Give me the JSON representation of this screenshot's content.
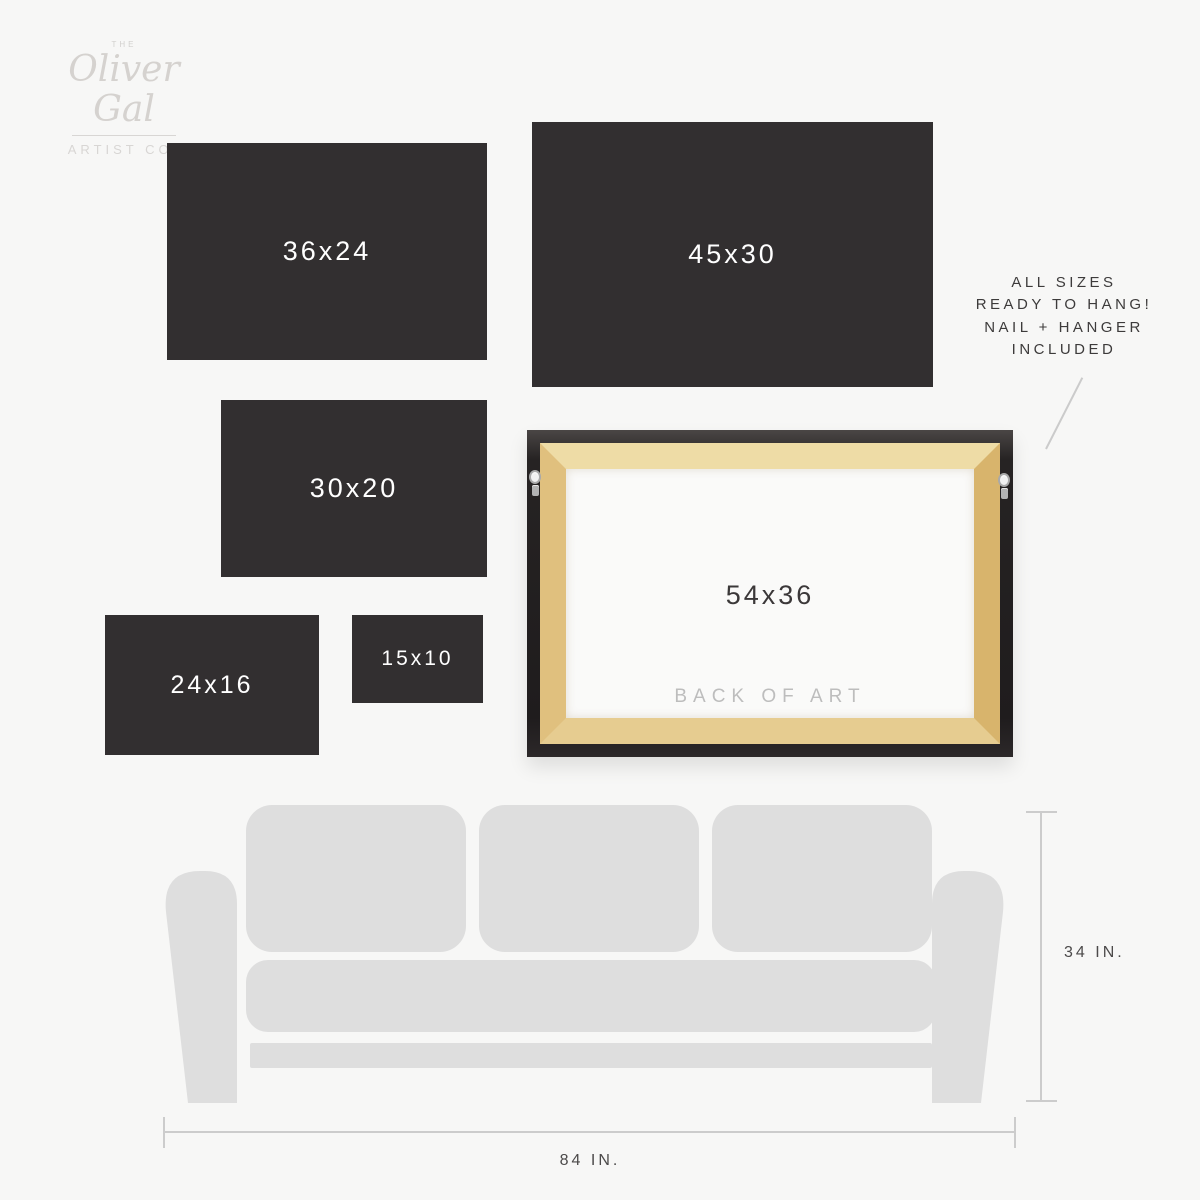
{
  "brand": {
    "pre": "THE",
    "name": "Oliver Gal",
    "sub": "ARTIST CO."
  },
  "panels": [
    {
      "label": "36x24"
    },
    {
      "label": "45x30"
    },
    {
      "label": "30x20"
    },
    {
      "label": "24x16"
    },
    {
      "label": "15x10"
    }
  ],
  "frame": {
    "size_label": "54x36",
    "caption": "BACK OF ART"
  },
  "note": {
    "line1": "ALL SIZES",
    "line2": "READY TO HANG!",
    "line3": "NAIL + HANGER",
    "line4": "INCLUDED"
  },
  "dimensions": {
    "sofa_height": "34 IN.",
    "sofa_width": "84 IN."
  },
  "colors": {
    "background": "#f7f7f6",
    "panel": "#322f30",
    "panel_text": "#ffffff",
    "frame_black": "#232021",
    "wood": "#e4c98b",
    "canvas_back": "#fafaf9",
    "sofa": "#dedede",
    "dimension_line": "#cccccc",
    "note_text": "#3d3b3b",
    "caption_muted": "#bdbdbd",
    "logo_gray": "#d5d2cf"
  }
}
